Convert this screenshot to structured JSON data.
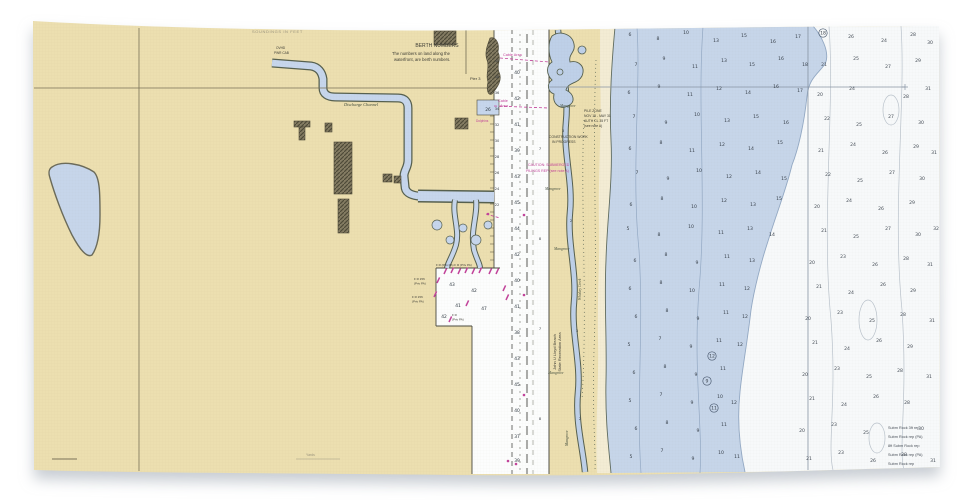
{
  "product": {
    "name": "nautical chart beach towel photo"
  },
  "colors": {
    "land_tan": "#ecdfb0",
    "sand": "#f3ecd4",
    "water_blue": "#c6d5e9",
    "deep_white": "#f7f9fa",
    "outline_olive": "#5d5b48",
    "magenta": "#c2439a",
    "grid_olive": "#8a8164",
    "contour_blue": "#93a9c4",
    "contour_gray": "#b9c2cb"
  },
  "labels": {
    "top_note": "SOUNDINGS IN FEET",
    "berth_title": "BERTH NUMBERS",
    "berth_note1": "The numbers on land along the",
    "berth_note2": "waterfront, are berth numbers.",
    "pier_top": "Pier 2",
    "pier_mid": "Pier 3",
    "discharge_channel": "Discharge Channel",
    "ovhd1": "OVHD",
    "ovhd2": "PWR CAB",
    "cable_area_top": "Cable Area",
    "cable_word1": "Cable",
    "cable_word2": "Area",
    "wharf_depth": "26",
    "dolphins": "Dolphins",
    "pile_zone": [
      "PILE ZONE",
      "NOV 15 - MAY 31",
      "AUTH CL 35 FT",
      "(see note A)"
    ],
    "construction": [
      "CONSTRUCTION WORK",
      "IN PROGRESS"
    ],
    "caution": [
      "CAUTION: SUBMERGED",
      "PILINGS REP (see note A)"
    ],
    "mangrove": "Mangrove",
    "park_line1": "John U Lloyd Beach",
    "park_line2": "State Recreation Area",
    "whiskey_creek": "Whiskey Creek",
    "basin_note_top": "F R (Priv PA)   F R (Priv PA)",
    "basin_left1a": "F R 15ft",
    "basin_left1b": "(Priv PA)",
    "basin_left2a": "F R 15ft",
    "basin_left2b": "(Priv PA)",
    "basin_inner_a": "F R",
    "basin_inner_b": "(Priv PA)",
    "scale_note": "Yards"
  },
  "notes_bottom_right": [
    "Subm Rock 3ft rep",
    "Subm Rock rep (PA)",
    "8ft Subm Rock rep",
    "Subm Rock rep (PA)",
    "Subm Rock rep"
  ],
  "soundings": {
    "shallow": [
      [
        630,
        36,
        "6"
      ],
      [
        658,
        40,
        "8"
      ],
      [
        686,
        34,
        "10"
      ],
      [
        716,
        42,
        "13"
      ],
      [
        744,
        37,
        "15"
      ],
      [
        773,
        43,
        "16"
      ],
      [
        798,
        38,
        "17"
      ],
      [
        636,
        66,
        "7"
      ],
      [
        664,
        60,
        "9"
      ],
      [
        695,
        68,
        "11"
      ],
      [
        724,
        62,
        "13"
      ],
      [
        752,
        66,
        "15"
      ],
      [
        781,
        60,
        "16"
      ],
      [
        805,
        66,
        "18"
      ],
      [
        629,
        94,
        "6"
      ],
      [
        659,
        88,
        "9"
      ],
      [
        690,
        96,
        "11"
      ],
      [
        719,
        90,
        "12"
      ],
      [
        748,
        94,
        "14"
      ],
      [
        776,
        88,
        "16"
      ],
      [
        800,
        92,
        "17"
      ],
      [
        634,
        118,
        "7"
      ],
      [
        666,
        124,
        "9"
      ],
      [
        697,
        116,
        "10"
      ],
      [
        727,
        122,
        "13"
      ],
      [
        756,
        118,
        "15"
      ],
      [
        786,
        124,
        "16"
      ],
      [
        630,
        150,
        "6"
      ],
      [
        661,
        144,
        "8"
      ],
      [
        692,
        152,
        "11"
      ],
      [
        722,
        146,
        "12"
      ],
      [
        751,
        150,
        "14"
      ],
      [
        780,
        144,
        "15"
      ],
      [
        637,
        174,
        "7"
      ],
      [
        668,
        180,
        "9"
      ],
      [
        699,
        172,
        "10"
      ],
      [
        729,
        178,
        "12"
      ],
      [
        758,
        174,
        "14"
      ],
      [
        784,
        180,
        "15"
      ],
      [
        631,
        206,
        "6"
      ],
      [
        662,
        200,
        "8"
      ],
      [
        694,
        208,
        "10"
      ],
      [
        724,
        202,
        "12"
      ],
      [
        753,
        206,
        "13"
      ],
      [
        779,
        200,
        "15"
      ],
      [
        628,
        230,
        "5"
      ],
      [
        659,
        236,
        "8"
      ],
      [
        691,
        228,
        "10"
      ],
      [
        721,
        234,
        "11"
      ],
      [
        750,
        230,
        "13"
      ],
      [
        772,
        236,
        "14"
      ],
      [
        635,
        262,
        "6"
      ],
      [
        666,
        256,
        "8"
      ],
      [
        697,
        264,
        "9"
      ],
      [
        727,
        258,
        "11"
      ],
      [
        752,
        262,
        "13"
      ],
      [
        630,
        290,
        "6"
      ],
      [
        661,
        284,
        "8"
      ],
      [
        692,
        292,
        "10"
      ],
      [
        722,
        286,
        "11"
      ],
      [
        747,
        290,
        "12"
      ],
      [
        636,
        318,
        "6"
      ],
      [
        667,
        312,
        "8"
      ],
      [
        698,
        320,
        "9"
      ],
      [
        726,
        314,
        "11"
      ],
      [
        745,
        318,
        "12"
      ],
      [
        629,
        346,
        "5"
      ],
      [
        660,
        340,
        "7"
      ],
      [
        691,
        348,
        "9"
      ],
      [
        719,
        342,
        "11"
      ],
      [
        740,
        346,
        "12"
      ],
      [
        634,
        374,
        "6"
      ],
      [
        665,
        368,
        "8"
      ],
      [
        696,
        376,
        "9"
      ],
      [
        723,
        370,
        "11"
      ],
      [
        630,
        402,
        "5"
      ],
      [
        661,
        396,
        "7"
      ],
      [
        692,
        404,
        "9"
      ],
      [
        720,
        398,
        "10"
      ],
      [
        734,
        404,
        "12"
      ],
      [
        636,
        430,
        "6"
      ],
      [
        667,
        424,
        "8"
      ],
      [
        698,
        432,
        "9"
      ],
      [
        724,
        426,
        "11"
      ],
      [
        631,
        458,
        "5"
      ],
      [
        662,
        452,
        "7"
      ],
      [
        693,
        460,
        "9"
      ],
      [
        721,
        454,
        "10"
      ],
      [
        737,
        458,
        "11"
      ]
    ],
    "deep": [
      [
        851,
        38,
        "26"
      ],
      [
        884,
        42,
        "24"
      ],
      [
        913,
        36,
        "28"
      ],
      [
        930,
        44,
        "30"
      ],
      [
        824,
        66,
        "21"
      ],
      [
        856,
        60,
        "25"
      ],
      [
        888,
        68,
        "27"
      ],
      [
        918,
        62,
        "29"
      ],
      [
        820,
        96,
        "20"
      ],
      [
        852,
        90,
        "24"
      ],
      [
        906,
        98,
        "28"
      ],
      [
        928,
        90,
        "31"
      ],
      [
        827,
        120,
        "22"
      ],
      [
        859,
        126,
        "25"
      ],
      [
        891,
        118,
        "27"
      ],
      [
        921,
        124,
        "30"
      ],
      [
        821,
        152,
        "21"
      ],
      [
        853,
        146,
        "24"
      ],
      [
        885,
        154,
        "26"
      ],
      [
        916,
        148,
        "29"
      ],
      [
        934,
        154,
        "31"
      ],
      [
        828,
        176,
        "22"
      ],
      [
        860,
        182,
        "25"
      ],
      [
        892,
        174,
        "27"
      ],
      [
        922,
        180,
        "30"
      ],
      [
        817,
        208,
        "20"
      ],
      [
        849,
        202,
        "24"
      ],
      [
        881,
        210,
        "26"
      ],
      [
        912,
        204,
        "29"
      ],
      [
        824,
        232,
        "21"
      ],
      [
        856,
        238,
        "25"
      ],
      [
        888,
        230,
        "27"
      ],
      [
        918,
        236,
        "30"
      ],
      [
        936,
        230,
        "32"
      ],
      [
        812,
        264,
        "20"
      ],
      [
        843,
        258,
        "23"
      ],
      [
        875,
        266,
        "26"
      ],
      [
        906,
        260,
        "28"
      ],
      [
        930,
        266,
        "31"
      ],
      [
        819,
        288,
        "21"
      ],
      [
        851,
        294,
        "24"
      ],
      [
        883,
        286,
        "26"
      ],
      [
        913,
        292,
        "29"
      ],
      [
        808,
        320,
        "20"
      ],
      [
        840,
        314,
        "23"
      ],
      [
        872,
        322,
        "25"
      ],
      [
        903,
        316,
        "28"
      ],
      [
        932,
        322,
        "31"
      ],
      [
        815,
        344,
        "21"
      ],
      [
        847,
        350,
        "24"
      ],
      [
        879,
        342,
        "26"
      ],
      [
        910,
        348,
        "29"
      ],
      [
        805,
        376,
        "20"
      ],
      [
        837,
        370,
        "23"
      ],
      [
        869,
        378,
        "25"
      ],
      [
        900,
        372,
        "28"
      ],
      [
        929,
        378,
        "31"
      ],
      [
        812,
        400,
        "21"
      ],
      [
        844,
        406,
        "24"
      ],
      [
        876,
        398,
        "26"
      ],
      [
        907,
        404,
        "28"
      ],
      [
        802,
        432,
        "20"
      ],
      [
        834,
        426,
        "23"
      ],
      [
        866,
        434,
        "25"
      ],
      [
        921,
        430,
        "30"
      ],
      [
        809,
        460,
        "21"
      ],
      [
        841,
        454,
        "23"
      ],
      [
        873,
        462,
        "26"
      ],
      [
        904,
        456,
        "28"
      ],
      [
        933,
        462,
        "31"
      ]
    ],
    "channel": [
      [
        517,
        74,
        "40"
      ],
      [
        517,
        100,
        "42"
      ],
      [
        517,
        126,
        "41"
      ],
      [
        517,
        152,
        "39"
      ],
      [
        517,
        178,
        "43"
      ],
      [
        517,
        204,
        "45"
      ],
      [
        517,
        230,
        "44"
      ],
      [
        517,
        256,
        "42"
      ],
      [
        517,
        282,
        "40"
      ],
      [
        517,
        308,
        "41"
      ],
      [
        517,
        334,
        "38"
      ],
      [
        517,
        360,
        "43"
      ],
      [
        517,
        386,
        "45"
      ],
      [
        517,
        412,
        "40"
      ],
      [
        517,
        438,
        "37"
      ],
      [
        517,
        462,
        "39"
      ]
    ],
    "east_bank": [
      [
        540,
        150,
        "7"
      ],
      [
        540,
        240,
        "8"
      ],
      [
        540,
        330,
        "7"
      ],
      [
        540,
        420,
        "8"
      ]
    ],
    "berths": [
      [
        497,
        62,
        "40"
      ],
      [
        497,
        78,
        "38"
      ],
      [
        497,
        94,
        "36"
      ],
      [
        497,
        110,
        "34"
      ],
      [
        497,
        126,
        "32"
      ],
      [
        497,
        142,
        "30"
      ],
      [
        497,
        158,
        "28"
      ],
      [
        497,
        174,
        "26"
      ],
      [
        497,
        190,
        "24"
      ],
      [
        497,
        206,
        "22"
      ]
    ],
    "basin": [
      [
        452,
        286,
        "43"
      ],
      [
        474,
        292,
        "42"
      ],
      [
        458,
        307,
        "41"
      ],
      [
        484,
        310,
        "47"
      ],
      [
        444,
        318,
        "42"
      ]
    ],
    "creek": [
      [
        563,
        132,
        "3"
      ],
      [
        571,
        222,
        "2"
      ],
      [
        577,
        332,
        "3"
      ],
      [
        580,
        420,
        "2"
      ]
    ],
    "circled": [
      [
        823,
        33,
        "18"
      ],
      [
        712,
        356,
        "12"
      ],
      [
        707,
        381,
        "9"
      ],
      [
        714,
        408,
        "11"
      ]
    ]
  },
  "features": {
    "daymarks": [
      [
        444,
        274
      ],
      [
        451,
        273
      ],
      [
        458,
        274
      ],
      [
        465,
        273
      ],
      [
        472,
        274
      ],
      [
        479,
        273
      ],
      [
        489,
        274
      ],
      [
        496,
        274
      ],
      [
        437,
        283
      ],
      [
        434,
        297
      ],
      [
        503,
        291
      ],
      [
        506,
        300
      ],
      [
        466,
        306
      ],
      [
        449,
        322
      ]
    ],
    "icw_ticks": [
      [
        524,
        215
      ],
      [
        524,
        295
      ],
      [
        524,
        395
      ],
      [
        508,
        461
      ],
      [
        516,
        464
      ],
      [
        488,
        214
      ]
    ]
  }
}
